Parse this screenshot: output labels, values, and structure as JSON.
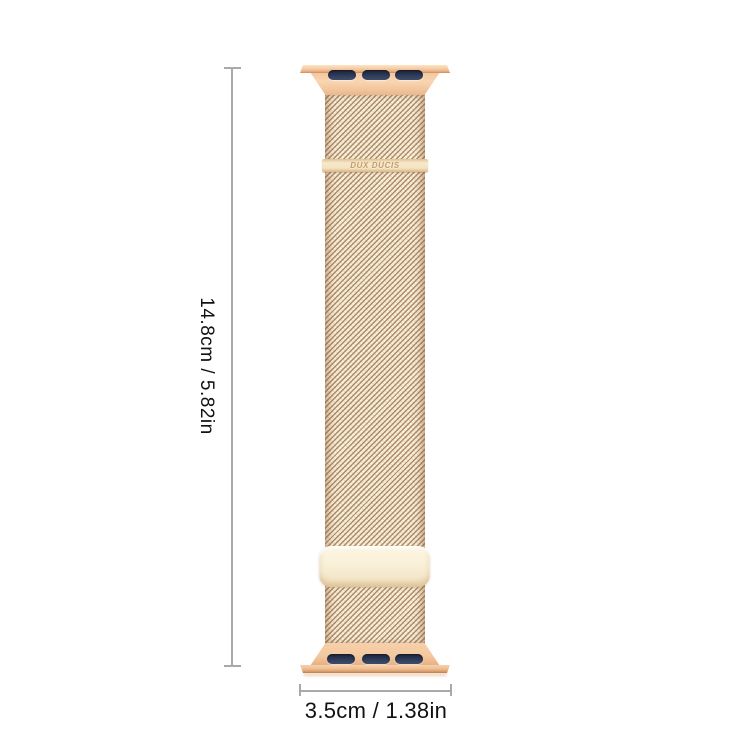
{
  "product": {
    "brand": "DUX DUCIS"
  },
  "dimensions": {
    "height_label": "14.8cm / 5.82in",
    "width_label": "3.5cm / 1.38in"
  },
  "colors": {
    "rose_gold": "#f3c9a2",
    "rose_gold_deep": "#cd9166",
    "slot_navy": "#2e3a57",
    "mesh_light": "#f7eeda",
    "mesh_dark": "#a97e55",
    "clasp_cream": "#f9f0da",
    "brand_plate": "#f3e4c2",
    "brand_text": "#c49a68",
    "dim_line": "#a9a9a9",
    "dim_text": "#111111",
    "background": "#ffffff"
  }
}
